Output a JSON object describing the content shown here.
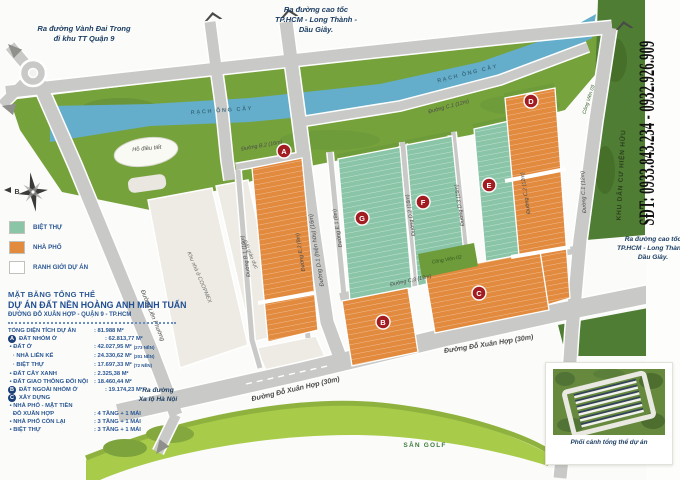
{
  "annotations": {
    "exit_top_left": [
      "Ra đường Vành Đai Trong",
      "đi khu TT Quận 9"
    ],
    "exit_top_mid": [
      "Ra đường cao tốc",
      "TP.HCM - Long Thành -",
      "Dầu Giây."
    ],
    "exit_right": [
      "Ra đường cao tốc",
      "TP.HCM - Long Thành -",
      "Dầu Giây."
    ],
    "exit_bottom_left": [
      "Ra đường",
      "Xa lộ Hà Nội"
    ],
    "phone": "SĐT: 0933.843.234 - 0932.926.909",
    "existing_area": "KHU DÂN CƯ HIỆN HỮU",
    "golf": "SÂN GOLF",
    "compass_north": "B"
  },
  "map": {
    "river_label": "RẠCH ÔNG CÂY",
    "pond_label": "Hồ điều tiết",
    "parks": {
      "p02": "Công Viên 02",
      "p03": "Công Viên 03"
    },
    "parcels": {
      "coopmex": "Khu nhà ở COOPMEX",
      "education": "Đất giáo dục"
    },
    "roads": {
      "b1": "Đường B.1 (16m)",
      "b2": "Đường B.2 (16m)",
      "e1": "Đường E.1 (8m)",
      "e2": "Đường E.2 (8m)",
      "d1": "Đường D.1 (hiện hữu) (16m)",
      "d2": "Đường D.2 (16m)",
      "d3": "Đường D.3 (16m)",
      "c1": "Đường C.1 (12m)",
      "c2": "Đường C.2 (12m)",
      "c3": "Đường C.3 (12m)",
      "do_xuan_hop": "Đường Đỗ Xuân Hợp (30m)",
      "lien_phuong": "Đường Liên Phường"
    },
    "markers": {
      "a": "A",
      "b": "B",
      "c": "C",
      "d": "D",
      "e": "E",
      "f": "F",
      "g": "G"
    },
    "marker_color": "#a11d22",
    "colors": {
      "villa_teal": "#8ac5a8",
      "townhouse_orange": "#e28a3e",
      "river_blue": "#64aecb",
      "green_area": "#76a23c",
      "existing_strip_green": "#4f7d33",
      "golf_lime": "#a8cc4a",
      "road_gray": "#c9c9c7"
    }
  },
  "legend": {
    "items": [
      {
        "label": "BIỆT THỰ",
        "color": "#8ac5a8"
      },
      {
        "label": "NHÀ PHỐ",
        "color": "#e28a3e"
      },
      {
        "label": "RANH GIỚI DỰ ÁN",
        "color": "#ffffff"
      }
    ]
  },
  "info": {
    "title1": "MẶT BẰNG TỔNG THỂ",
    "title2": "DỰ ÁN ĐẤT NỀN HOÀNG ANH MINH TUẤN",
    "subtitle": "ĐƯỜNG ĐỖ XUÂN HỢP - QUẬN 9 - TP.HCM",
    "rows": [
      {
        "badge": "",
        "label": "TỔNG DIỆN TÍCH DỰ ÁN",
        "value": ": 81.988 M²",
        "note": ""
      },
      {
        "badge": "A",
        "label": "ĐẤT NHÓM Ở",
        "value": ": 62.813,77 M²",
        "note": ""
      },
      {
        "badge": "",
        "label": " • ĐẤT Ở",
        "value": ": 42.027,95 M²",
        "note": "(273 NỀN)"
      },
      {
        "badge": "",
        "label": "   · NHÀ LIÊN KẾ",
        "value": ": 24.330,62 M²",
        "note": "(201 NỀN)"
      },
      {
        "badge": "",
        "label": "   · BIỆT THỰ",
        "value": ": 17.697,33 M²",
        "note": "(72 NỀN)"
      },
      {
        "badge": "",
        "label": " • ĐẤT CÂY XANH",
        "value": ": 2.325,38 M²",
        "note": ""
      },
      {
        "badge": "",
        "label": " • ĐẤT GIAO THÔNG ĐỐI NỘI",
        "value": ": 18.460,44 M²",
        "note": ""
      },
      {
        "badge": "B",
        "label": "ĐẤT NGOÀI NHÓM Ở",
        "value": ": 19.174,23 M²",
        "note": ""
      },
      {
        "badge": "C",
        "label": "XÂY DỰNG",
        "value": "",
        "note": ""
      },
      {
        "badge": "",
        "label": " • NHÀ PHỐ - MẶT TIỀN",
        "value": "",
        "note": ""
      },
      {
        "badge": "",
        "label": "   ĐỖ XUÂN HỢP",
        "value": ": 4 TẦNG + 1 MÁI",
        "note": ""
      },
      {
        "badge": "",
        "label": " • NHÀ PHỐ CÒN LẠI",
        "value": ": 3 TẦNG + 1 MÁI",
        "note": ""
      },
      {
        "badge": "",
        "label": " • BIỆT THỰ",
        "value": ": 3 TẦNG + 1 MÁI",
        "note": ""
      }
    ]
  },
  "thumbnail": {
    "caption": "Phối cảnh tổng thể dự án"
  }
}
